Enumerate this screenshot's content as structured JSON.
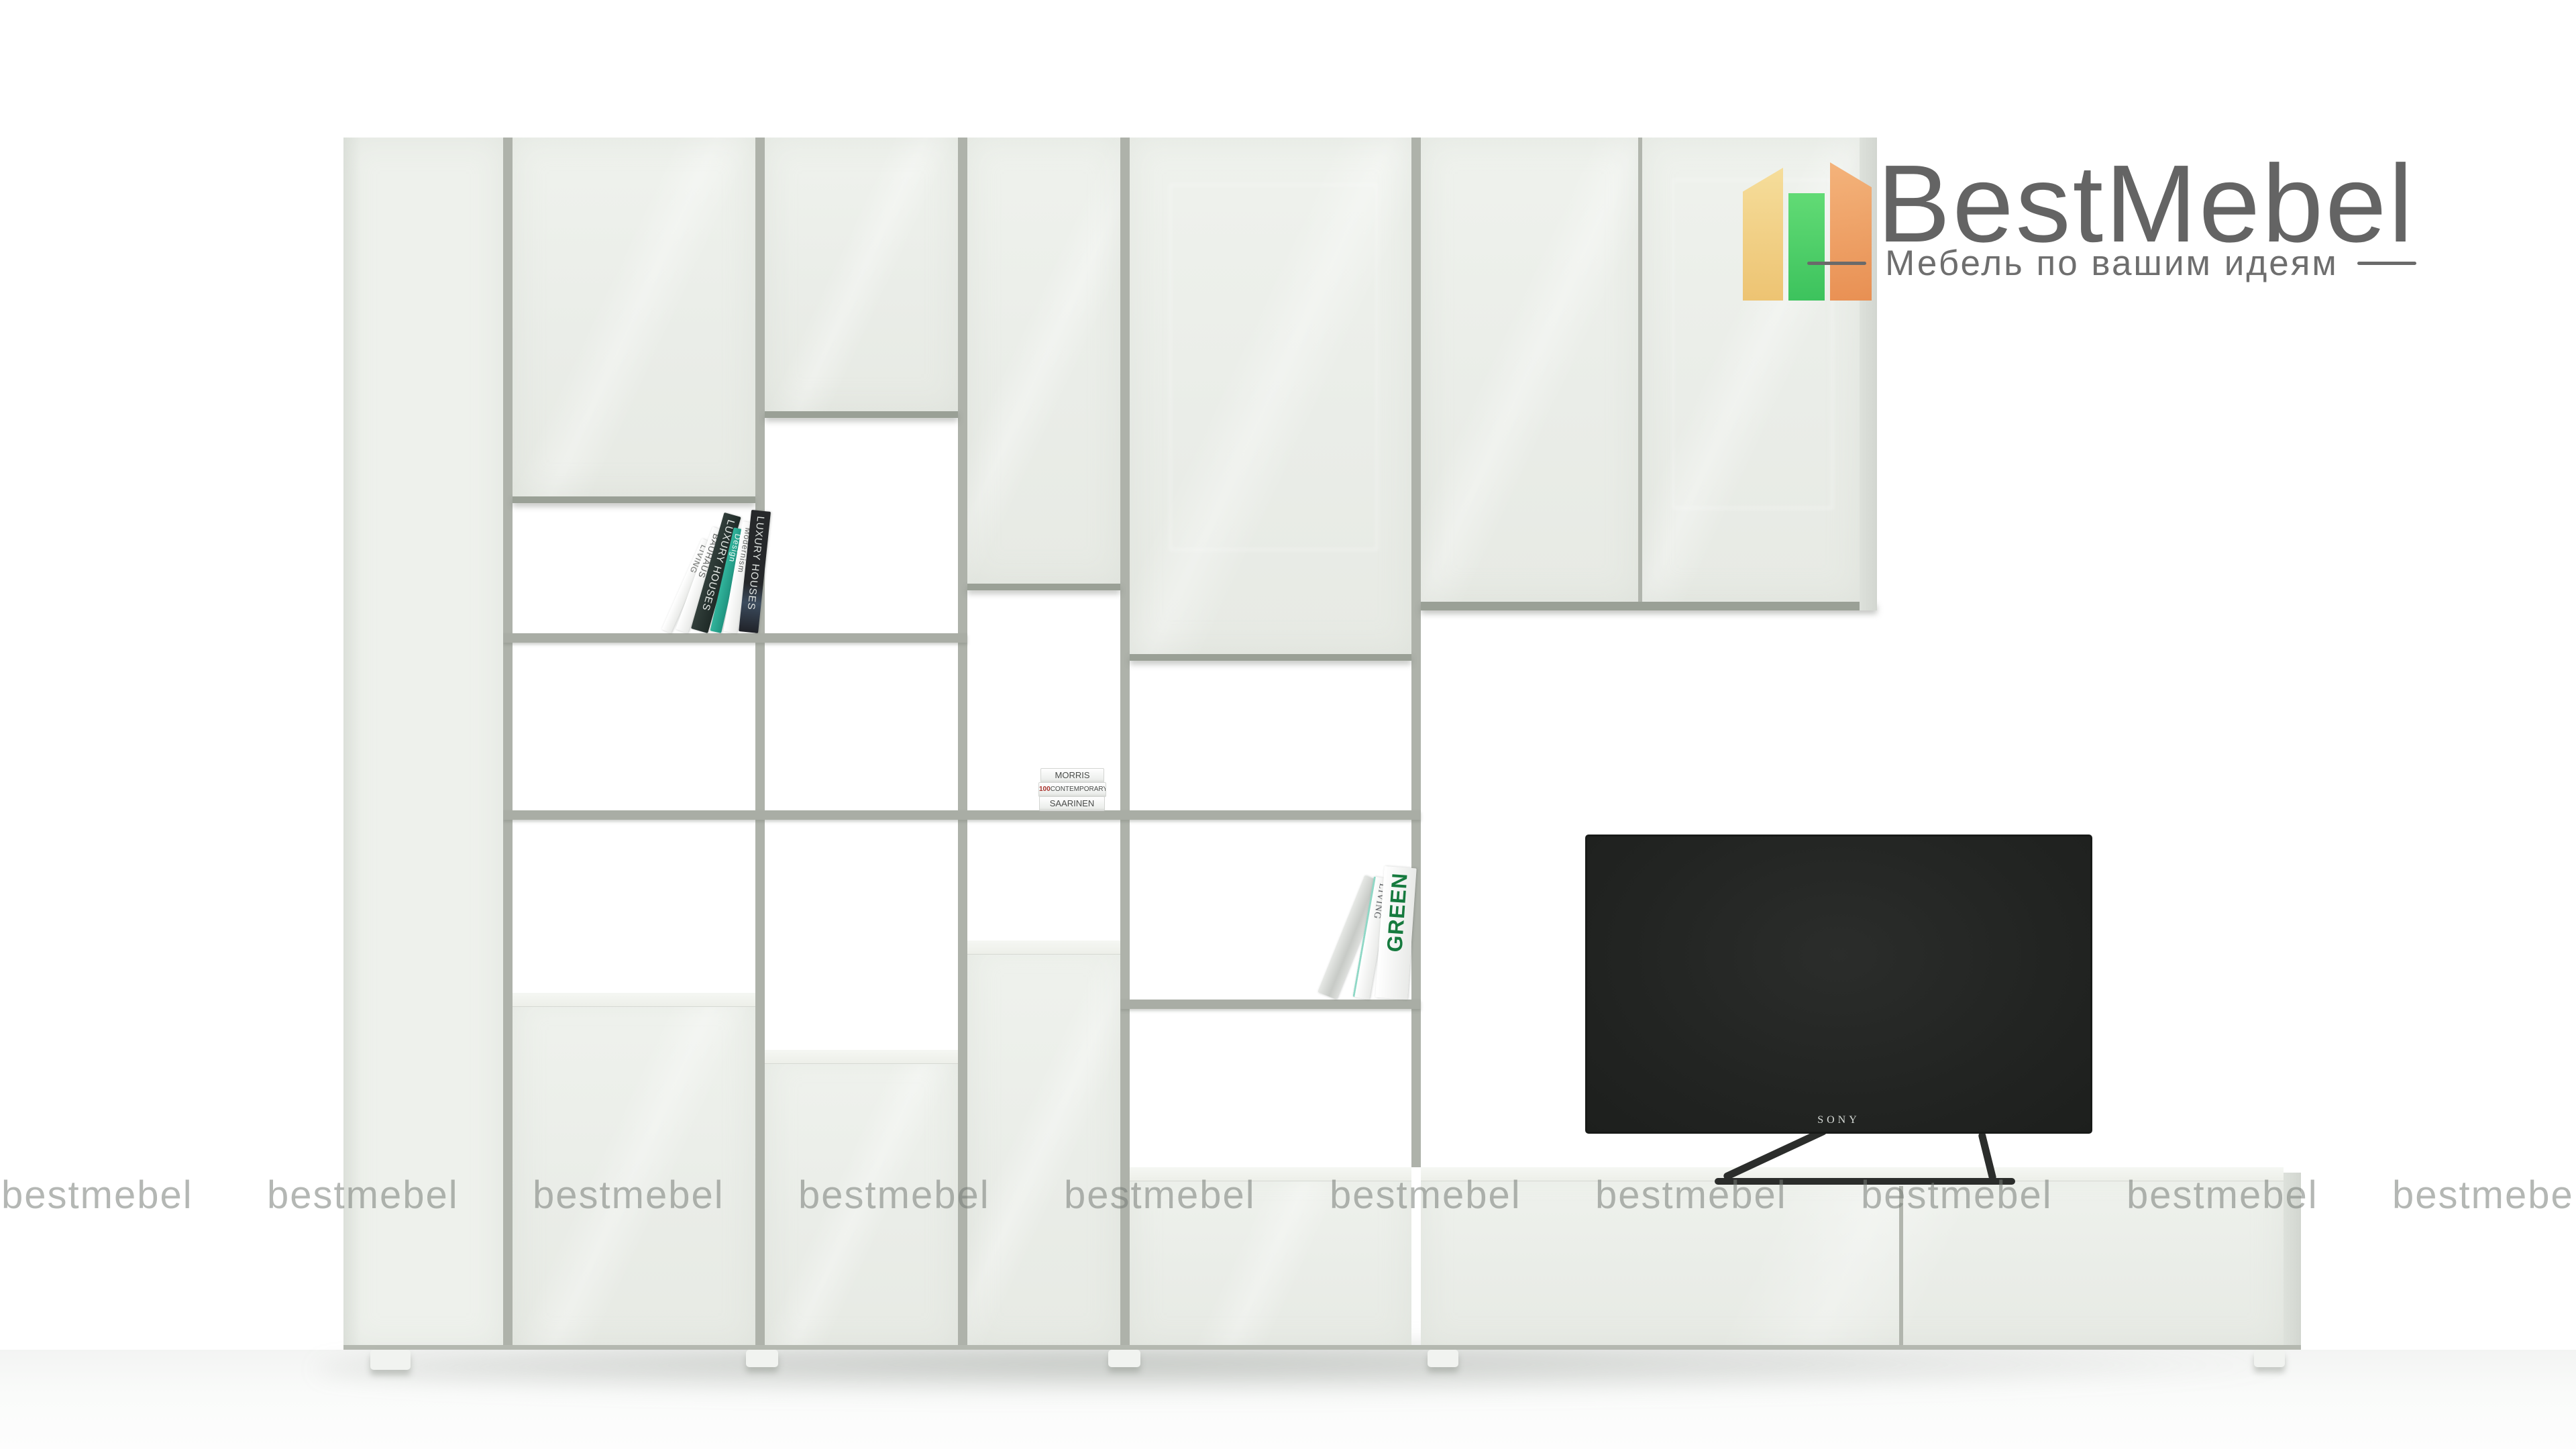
{
  "logo": {
    "title": "BestMebel",
    "tagline": "Мебель по вашим идеям",
    "title_color": "#646464",
    "icon_colors": {
      "yellow": "#f0cf7a",
      "green": "#3ecb5d",
      "orange": "#ee9a58"
    }
  },
  "watermark": {
    "text": "bestmebel",
    "repeat_count": 10,
    "color": "#b7bab7"
  },
  "tv": {
    "brand": "SONY",
    "screen_color": "#232523"
  },
  "books": {
    "leaning_left": [
      "LIVING",
      "BAUHAUS",
      "LUXURY HOUSES",
      "Design",
      "Modernism",
      "LUXURY HOUSES"
    ],
    "stack": {
      "top": "MORRIS",
      "middle_num": "100",
      "middle_rest": "CONTEMPORARY HOUSES",
      "bottom": "SAARINEN"
    },
    "leaning_right": [
      "LIVING",
      "GREEN"
    ]
  },
  "furniture_colors": {
    "panel": "#edf0eb",
    "frame": "#a9ada5"
  }
}
